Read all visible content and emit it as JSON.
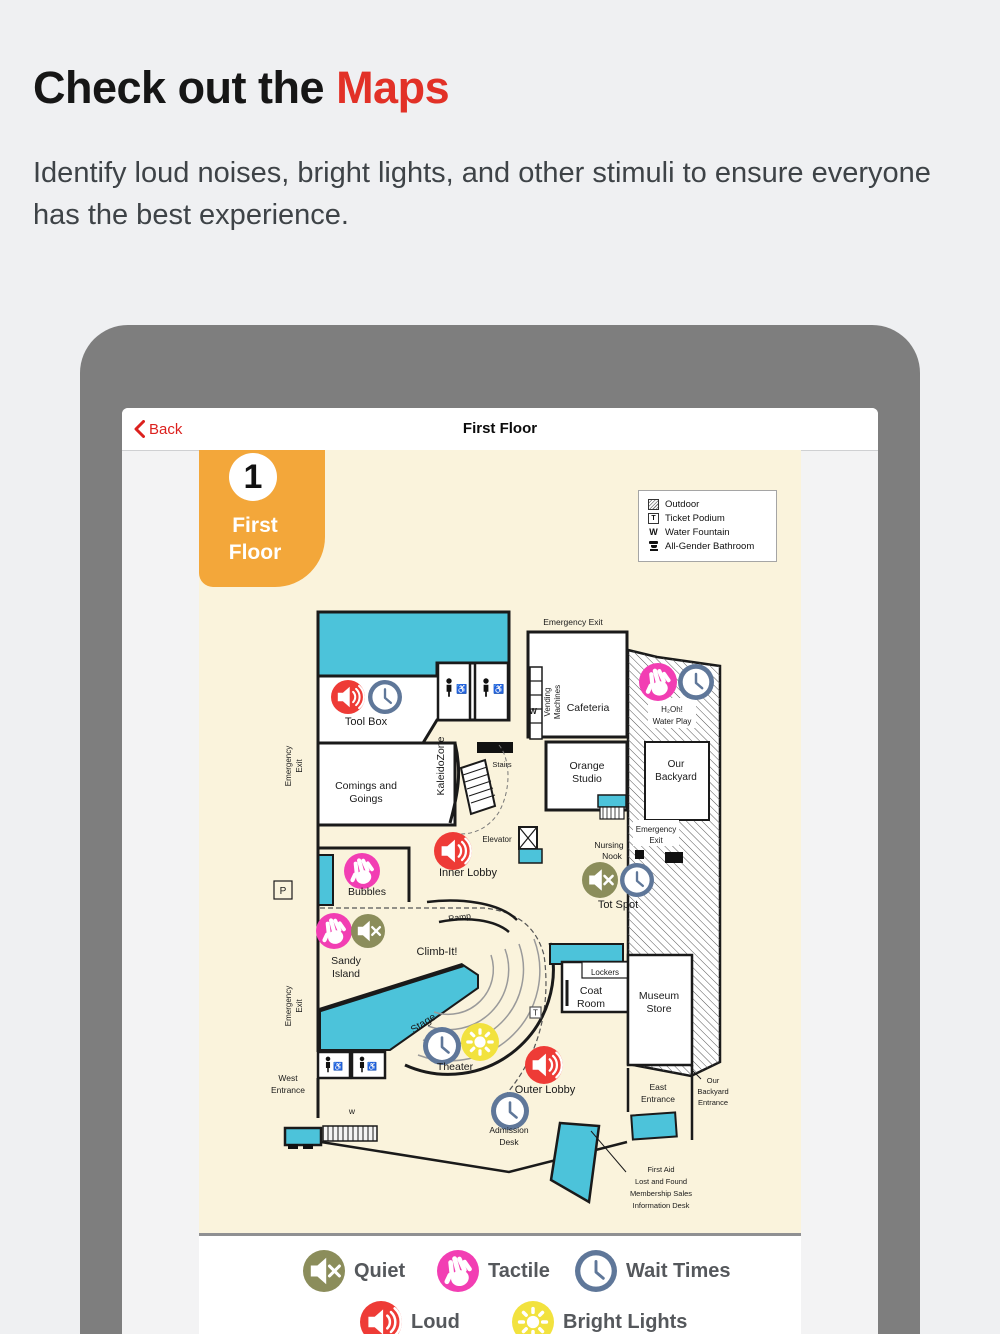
{
  "header": {
    "title_black": "Check out the",
    "title_red": "Maps",
    "subtitle": "Identify loud noises, bright lights, and other stimuli to ensure everyone has the best experience."
  },
  "nav": {
    "back_label": "Back",
    "title": "First Floor"
  },
  "badge": {
    "number": "1",
    "lines": [
      "First",
      "Floor"
    ]
  },
  "map_key": {
    "items": [
      {
        "icon": "outdoor-hatch-swatch",
        "label": "Outdoor"
      },
      {
        "icon": "ticket-podium-symbol",
        "label": "Ticket Podium"
      },
      {
        "icon": "water-fountain-symbol",
        "label": "Water Fountain"
      },
      {
        "icon": "all-gender-bathroom-icon",
        "label": "All-Gender Bathroom"
      }
    ]
  },
  "map": {
    "accessible_symbol": "♿",
    "labels": {
      "emergency_exit_top": "Emergency Exit",
      "vending": [
        "Vending",
        "Machines"
      ],
      "cafeteria": "Cafeteria",
      "w_cafe": "W",
      "tool_box": "Tool Box",
      "emergency_left_top": [
        "Emergency",
        "Exit"
      ],
      "comings": [
        "Comings and",
        "Goings"
      ],
      "kaleidozone": "KaleidoZone",
      "stairs": "Stairs",
      "orange_studio": [
        "Orange",
        "Studio"
      ],
      "h2oh": [
        "H₂Oh!",
        "Water Play"
      ],
      "our_backyard": [
        "Our",
        "Backyard"
      ],
      "emergency_backyard": [
        "Emergency",
        "Exit"
      ],
      "elevator": "Elevator",
      "inner_lobby": "Inner Lobby",
      "nursing_nook": [
        "Nursing",
        "Nook"
      ],
      "tot_spot": "Tot Spot",
      "bubbles": "Bubbles",
      "p": "P",
      "sandy": [
        "Sandy",
        "Island"
      ],
      "ramp": "Ramp",
      "climb": "Climb-It!",
      "lockers": "Lockers",
      "coat": [
        "Coat",
        "Room"
      ],
      "museum": [
        "Museum",
        "Store"
      ],
      "stage": "Stage",
      "theater": "Theater",
      "t": "T",
      "outer_lobby": "Outer Lobby",
      "admission": [
        "Admission",
        "Desk"
      ],
      "west_entrance": [
        "West",
        "Entrance"
      ],
      "w_west": "w",
      "emergency_left_bottom": [
        "Emergency",
        "Exit"
      ],
      "east_entrance": [
        "East",
        "Entrance"
      ],
      "backyard_entrance": [
        "Our",
        "Backyard",
        "Entrance"
      ],
      "first_aid": [
        "First Aid",
        "Lost and Found",
        "Membership Sales",
        "Information Desk"
      ]
    }
  },
  "legend": {
    "items": [
      {
        "icon": "quiet-icon",
        "label": "Quiet",
        "color": "#8b8d5b"
      },
      {
        "icon": "tactile-icon",
        "label": "Tactile",
        "color": "#f23eb3"
      },
      {
        "icon": "wait-times-icon",
        "label": "Wait Times",
        "color": "#5f7799"
      },
      {
        "icon": "loud-icon",
        "label": "Loud",
        "color": "#ee3b36"
      },
      {
        "icon": "bright-lights-icon",
        "label": "Bright Lights",
        "color": "#f2e23e"
      }
    ]
  },
  "colors": {
    "accent_red": "#e23127",
    "teal": "#4cc3da",
    "cream": "#faf3dc",
    "badge_orange": "#f3a73a",
    "tablet_gray": "#7e7e7e",
    "loud_red": "#ee3b36",
    "tactile_pink": "#f23eb3",
    "quiet_olive": "#8b8d5b",
    "clock_blue": "#5f7799",
    "bright_yellow": "#f2e23e"
  }
}
